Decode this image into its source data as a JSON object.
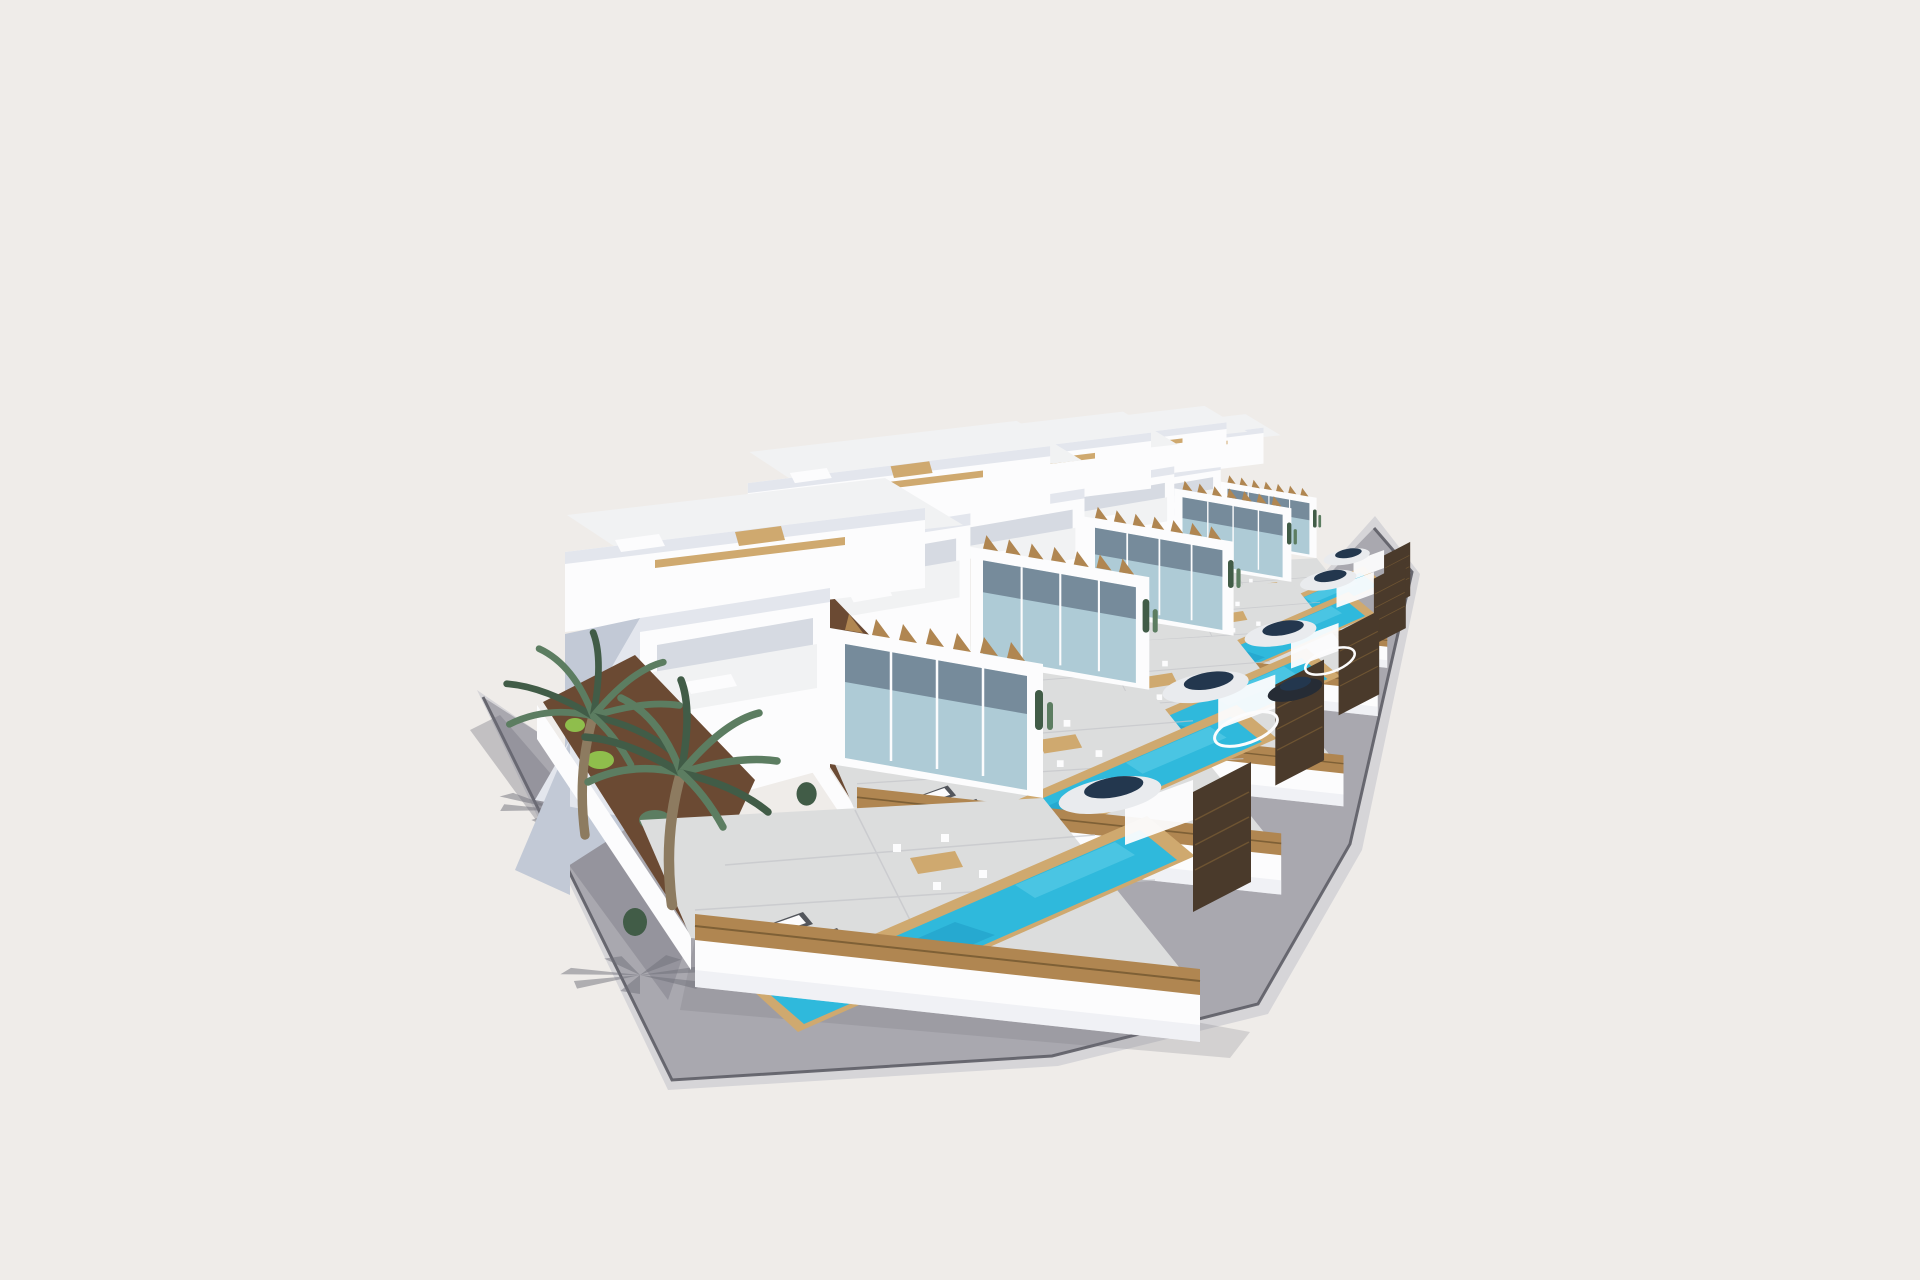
{
  "image": {
    "type": "3d-architectural-render",
    "subject": "Row of five identical modern white villas, each with a private pool, roof terrace and walled garden, shown in aerial three-quarter view on a plain light backdrop",
    "setting": "corner plot wrapped by an L-shaped gray street and sidewalk with palm-tree shadows"
  },
  "palette": {
    "background": "#EFECE9",
    "road_surface": "#A9A8AF",
    "road_shadow": "#70707A",
    "curb_dark": "#5D5D66",
    "curb_light": "#D6D5D8",
    "wall_white": "#FCFCFD",
    "wall_shade": "#E3E6ED",
    "wall_dark": "#C2C9D6",
    "wall_deep": "#8E9AAF",
    "roof_light": "#F1F2F3",
    "glass": "#AECBD6",
    "glass_dark": "#49586B",
    "pool_water": "#2FB9DC",
    "pool_deep": "#1C96C2",
    "pool_light": "#66D2E9",
    "wood": "#B08651",
    "wood_light": "#CFA96F",
    "wood_dark": "#7E6036",
    "slat_fence": "#4A3A2B",
    "terrace": "#DCDDDD",
    "terrace_shade": "#C3C5C9",
    "soil": "#6B4A33",
    "palm_trunk": "#8D7B60",
    "palm_green": "#5C7D61",
    "palm_green_dark": "#415C47",
    "plant_bright": "#8FBE4C",
    "plant_purple": "#95519A",
    "car_white": "#E9EBEE",
    "car_glass": "#23374E",
    "car_dark": "#262C35",
    "spa_dark": "#323D4B",
    "furniture_dark": "#53565C"
  },
  "scene": {
    "villa_count": 5,
    "villas": [
      {
        "name": "villa-1",
        "features": [
          "walled corner garden",
          "two tall palm trees",
          "three sun loungers",
          "outdoor dining set",
          "large private pool with wood surround",
          "wood street fence",
          "parked white car",
          "roof terrace"
        ]
      },
      {
        "name": "villa-2",
        "features": [
          "private pool",
          "dark round spa",
          "sun terrace",
          "parked white car",
          "roof terrace with dining set"
        ]
      },
      {
        "name": "villa-3",
        "features": [
          "private pool",
          "dark round spa",
          "parked dark car",
          "roof terrace"
        ]
      },
      {
        "name": "villa-4",
        "features": [
          "private pool",
          "terrace",
          "roof terrace"
        ]
      },
      {
        "name": "villa-5",
        "features": [
          "private pool",
          "terrace",
          "roof terrace"
        ]
      }
    ],
    "environment": [
      "L-shaped street with curbs",
      "sidewalk with palm shadows",
      "garden beds with cacti and shrubs"
    ]
  }
}
